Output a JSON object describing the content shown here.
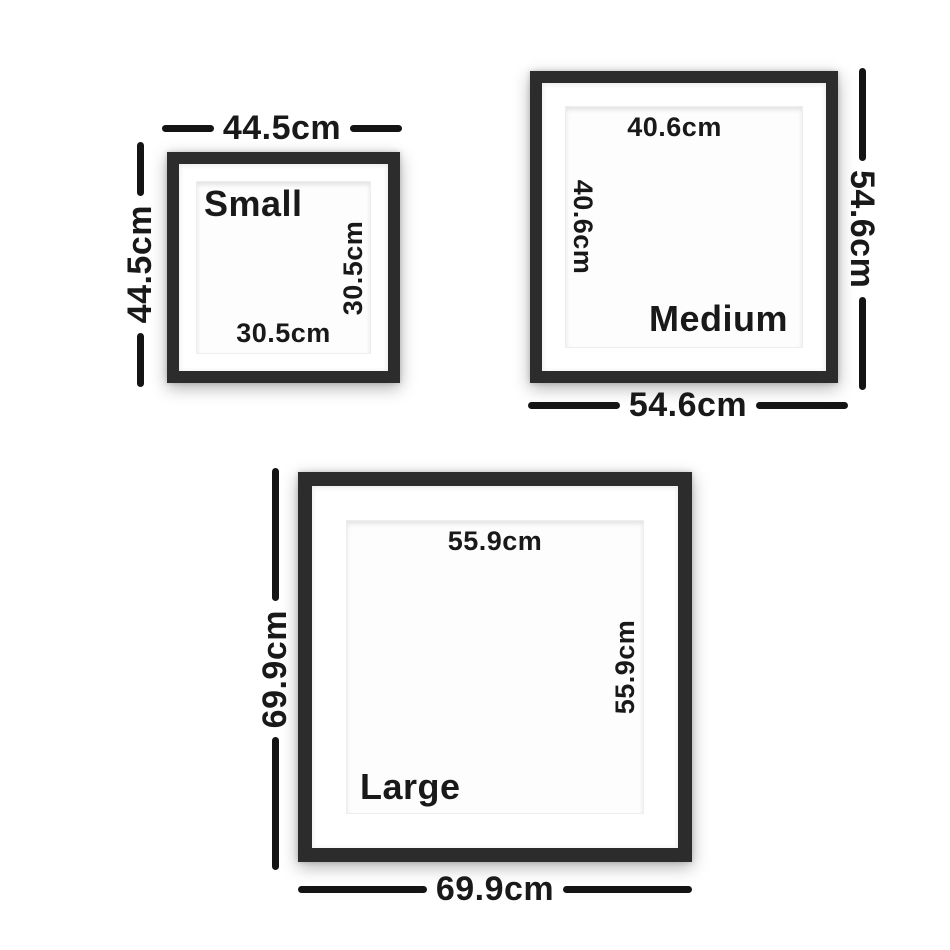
{
  "page": {
    "background": "#ffffff",
    "line_color": "#141414",
    "text_color": "#191919",
    "frame_color": "#2c2c2c",
    "mat_color": "#ffffff"
  },
  "frames": [
    {
      "id": "small",
      "label": "Small",
      "outer_width": "44.5cm",
      "outer_height": "44.5cm",
      "inner_width": "30.5cm",
      "inner_height": "30.5cm"
    },
    {
      "id": "medium",
      "label": "Medium",
      "outer_width": "54.6cm",
      "outer_height": "54.6cm",
      "inner_width": "40.6cm",
      "inner_height": "40.6cm"
    },
    {
      "id": "large",
      "label": "Large",
      "outer_width": "69.9cm",
      "outer_height": "69.9cm",
      "inner_width": "55.9cm",
      "inner_height": "55.9cm"
    }
  ]
}
